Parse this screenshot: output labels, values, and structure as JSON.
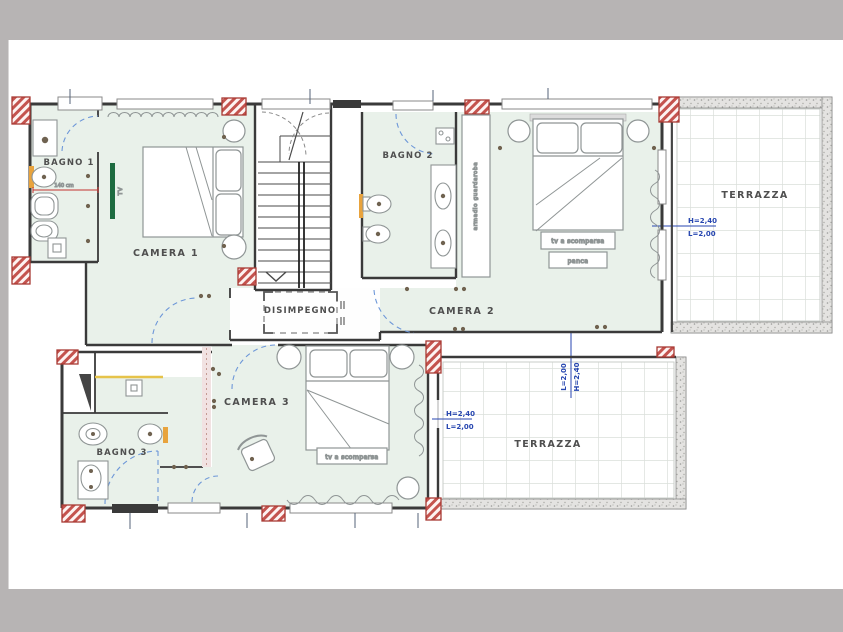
{
  "drawing": {
    "kind": "floor-plan"
  },
  "rooms": {
    "bagno1": {
      "label": "BAGNO 1"
    },
    "camera1": {
      "label": "CAMERA 1"
    },
    "bagno2": {
      "label": "BAGNO 2"
    },
    "camera2": {
      "label": "CAMERA 2"
    },
    "disimpegno": {
      "label": "DISIMPEGNO"
    },
    "camera3": {
      "label": "CAMERA 3"
    },
    "bagno3": {
      "label": "BAGNO 3"
    },
    "terrazza_top": {
      "label": "TERRAZZA",
      "dim_h": "H=2,40",
      "dim_l": "L=2,00"
    },
    "terrazza_bottom": {
      "label": "TERRAZZA",
      "dim_left_h": "H=2,40",
      "dim_left_l": "L=2,00",
      "dim_top_h": "H=2,40",
      "dim_top_l": "L=2,00"
    }
  },
  "furniture": {
    "camera1_tv": "TV",
    "camera2_wardrobe": "armadio guardaroba",
    "camera2_tv": "tv a scomparsa",
    "camera2_bench": "panca",
    "camera3_tv": "tv a scomparsa"
  },
  "dimensions": {
    "bagno1_width": "140 cm"
  },
  "colors": {
    "background": "#b7b4b4",
    "sheet": "#ffffff",
    "room_fill": "#e9f1ea",
    "wall": "#3a3a3a",
    "furniture_line": "#8f9595",
    "door_arc": "#6d97d8",
    "pillar_red": "#b8423c",
    "dim_blue": "#2746b0",
    "dim_red": "#c23230",
    "tv_green": "#1d6b40",
    "accent_orange": "#e8a33d",
    "accent_yellow": "#e6c34a"
  }
}
